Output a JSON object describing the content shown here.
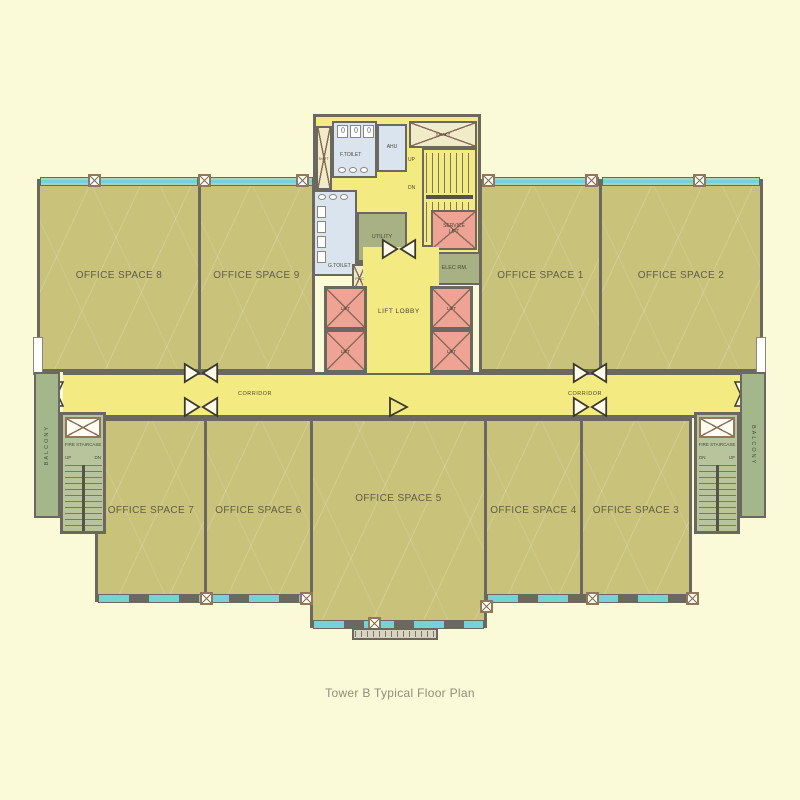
{
  "caption": "Tower B Typical Floor Plan",
  "offices": [
    {
      "label": "OFFICE SPACE 1"
    },
    {
      "label": "OFFICE SPACE 2"
    },
    {
      "label": "OFFICE SPACE 3"
    },
    {
      "label": "OFFICE SPACE 4"
    },
    {
      "label": "OFFICE SPACE 5"
    },
    {
      "label": "OFFICE SPACE 6"
    },
    {
      "label": "OFFICE SPACE 7"
    },
    {
      "label": "OFFICE SPACE 8"
    },
    {
      "label": "OFFICE SPACE 9"
    }
  ],
  "core": {
    "shaft": "SHAFT",
    "shaft_top": "SHAFT",
    "f_toilet": "F.TOILET",
    "g_toilet": "G.TOILET",
    "ahu": "AHU",
    "utility": "UTILITY",
    "phc": "PHC",
    "service_lift": "SERVICE LIFT",
    "elec_rm": "ELEC RM.",
    "lift_lobby": "LIFT LOBBY",
    "lift": "LIFT",
    "up": "UP",
    "dn": "DN"
  },
  "corridor": {
    "label": "CORRIDOR"
  },
  "fire_stair": {
    "title": "FIRE STAIRCASE",
    "up": "UP",
    "dn": "DN"
  },
  "balcony": {
    "label": "BALCONY"
  },
  "colors": {
    "background": "#FAFAD8",
    "office": "#C9C27B",
    "corridor": "#F3EA82",
    "toilet_blue": "#D9E4EF",
    "service_green": "#A8B184",
    "lift_pink": "#EFA394",
    "wall": "#6B695F",
    "window_teal": "#74D3D6",
    "balcony_green": "#A3B68C"
  }
}
